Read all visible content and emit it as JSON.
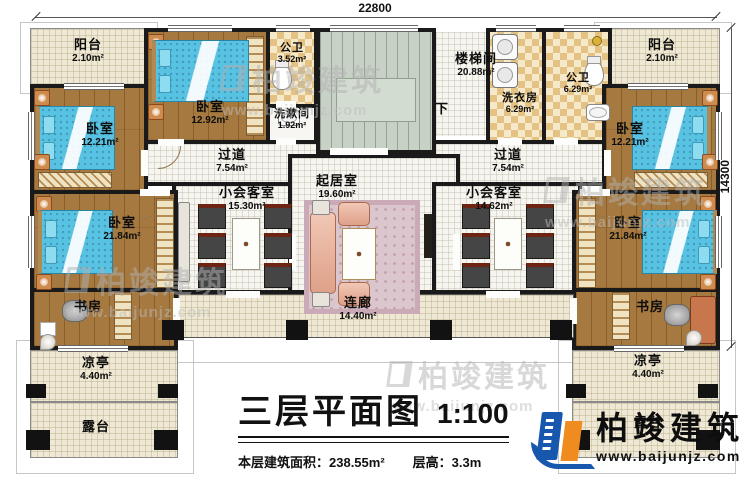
{
  "dimensions": {
    "top": "22800",
    "right": "14300"
  },
  "rooms": {
    "balcony_left": {
      "name": "阳台",
      "area": "2.10m²"
    },
    "balcony_right": {
      "name": "阳台",
      "area": "2.10m²"
    },
    "bedroom_left_top": {
      "name": "卧室",
      "area": "12.21m²"
    },
    "bedroom_mid_left": {
      "name": "卧室",
      "area": "12.92m²"
    },
    "bath_small": {
      "name": "公卫",
      "area": "3.52m²"
    },
    "washroom": {
      "name": "洗漱间",
      "area": "1.92m²"
    },
    "corridor_left": {
      "name": "过道",
      "area": "7.54m²"
    },
    "stairwell": {
      "name": "楼梯间",
      "area": "20.88m²",
      "down_label": "下"
    },
    "laundry": {
      "name": "洗衣房",
      "area": "6.29m²"
    },
    "bath_right": {
      "name": "公卫",
      "area": "6.29m²"
    },
    "corridor_right": {
      "name": "过道",
      "area": "7.54m²"
    },
    "bedroom_right_top": {
      "name": "卧室",
      "area": "12.21m²"
    },
    "reception_left": {
      "name": "小会客室",
      "area": "15.30m²"
    },
    "living": {
      "name": "起居室",
      "area": "19.60m²"
    },
    "reception_right": {
      "name": "小会客室",
      "area": "14.62m²"
    },
    "bedroom_left_big": {
      "name": "卧室",
      "area": "21.84m²"
    },
    "bedroom_right_big": {
      "name": "卧室",
      "area": "21.84m²"
    },
    "study_left": {
      "name": "书房"
    },
    "study_right": {
      "name": "书房"
    },
    "corridor_bottom": {
      "name": "连廊",
      "area": "14.40m²"
    },
    "pavilion_left": {
      "name": "凉亭",
      "area": "4.40m²"
    },
    "pavilion_right": {
      "name": "凉亭",
      "area": "4.40m²"
    },
    "terrace_left": {
      "name": "露台"
    },
    "terrace_right": {
      "name": "露台"
    }
  },
  "title": {
    "text": "三层平面图",
    "scale": "1:100",
    "area_label": "本层建筑面积：238.55m²",
    "height_label": "层高：3.3m"
  },
  "logo": {
    "company": "柏竣建筑",
    "website": "www.baijunjz.com"
  },
  "watermark": {
    "company": "柏竣建筑",
    "website": "www.baijunjz.com"
  }
}
